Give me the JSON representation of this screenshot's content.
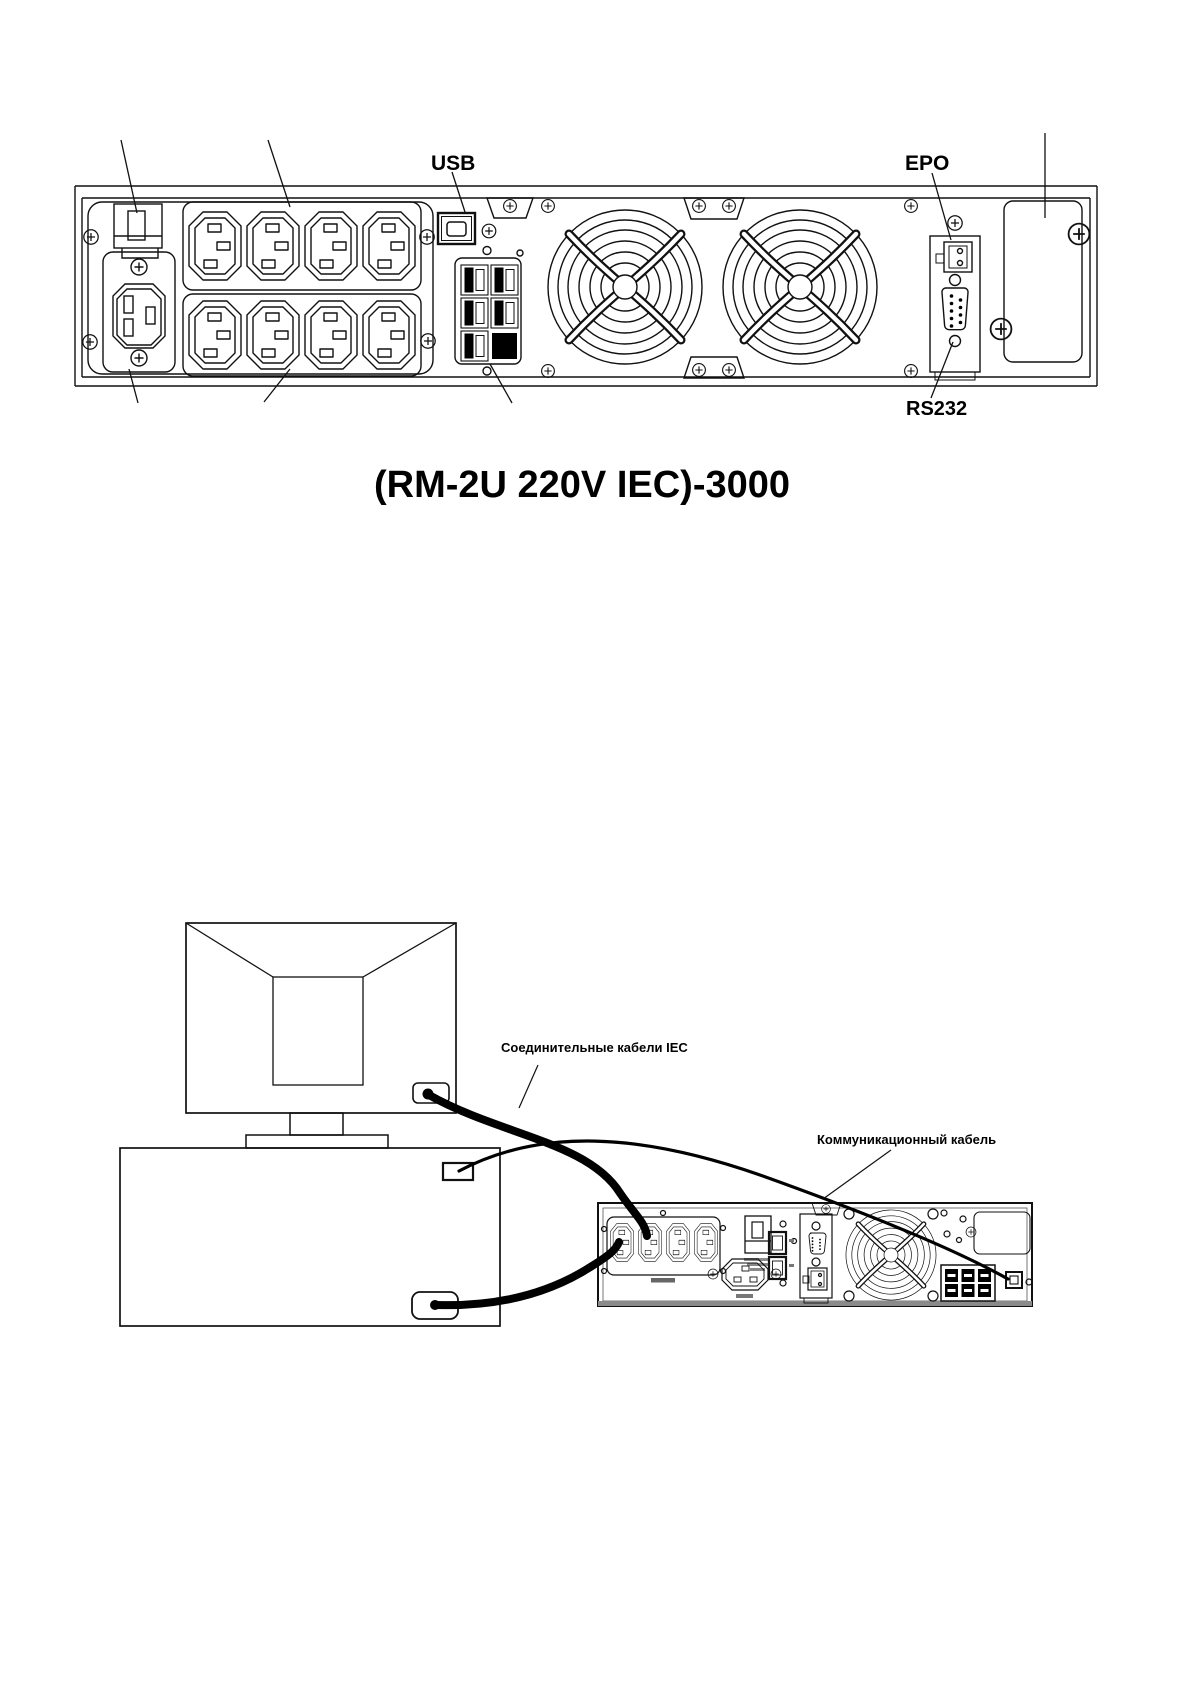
{
  "page": {
    "background": "#ffffff",
    "line_color": "#111111"
  },
  "rear_panel": {
    "usb_label": "USB",
    "epo_label": "EPO",
    "rs232_label": "RS232",
    "model_title": "(RM-2U 220V IEC)-3000"
  },
  "connection_diagram": {
    "iec_cables_label": "Соединительные кабели IEC",
    "communication_cable_label": "Коммуникационный кабель"
  }
}
